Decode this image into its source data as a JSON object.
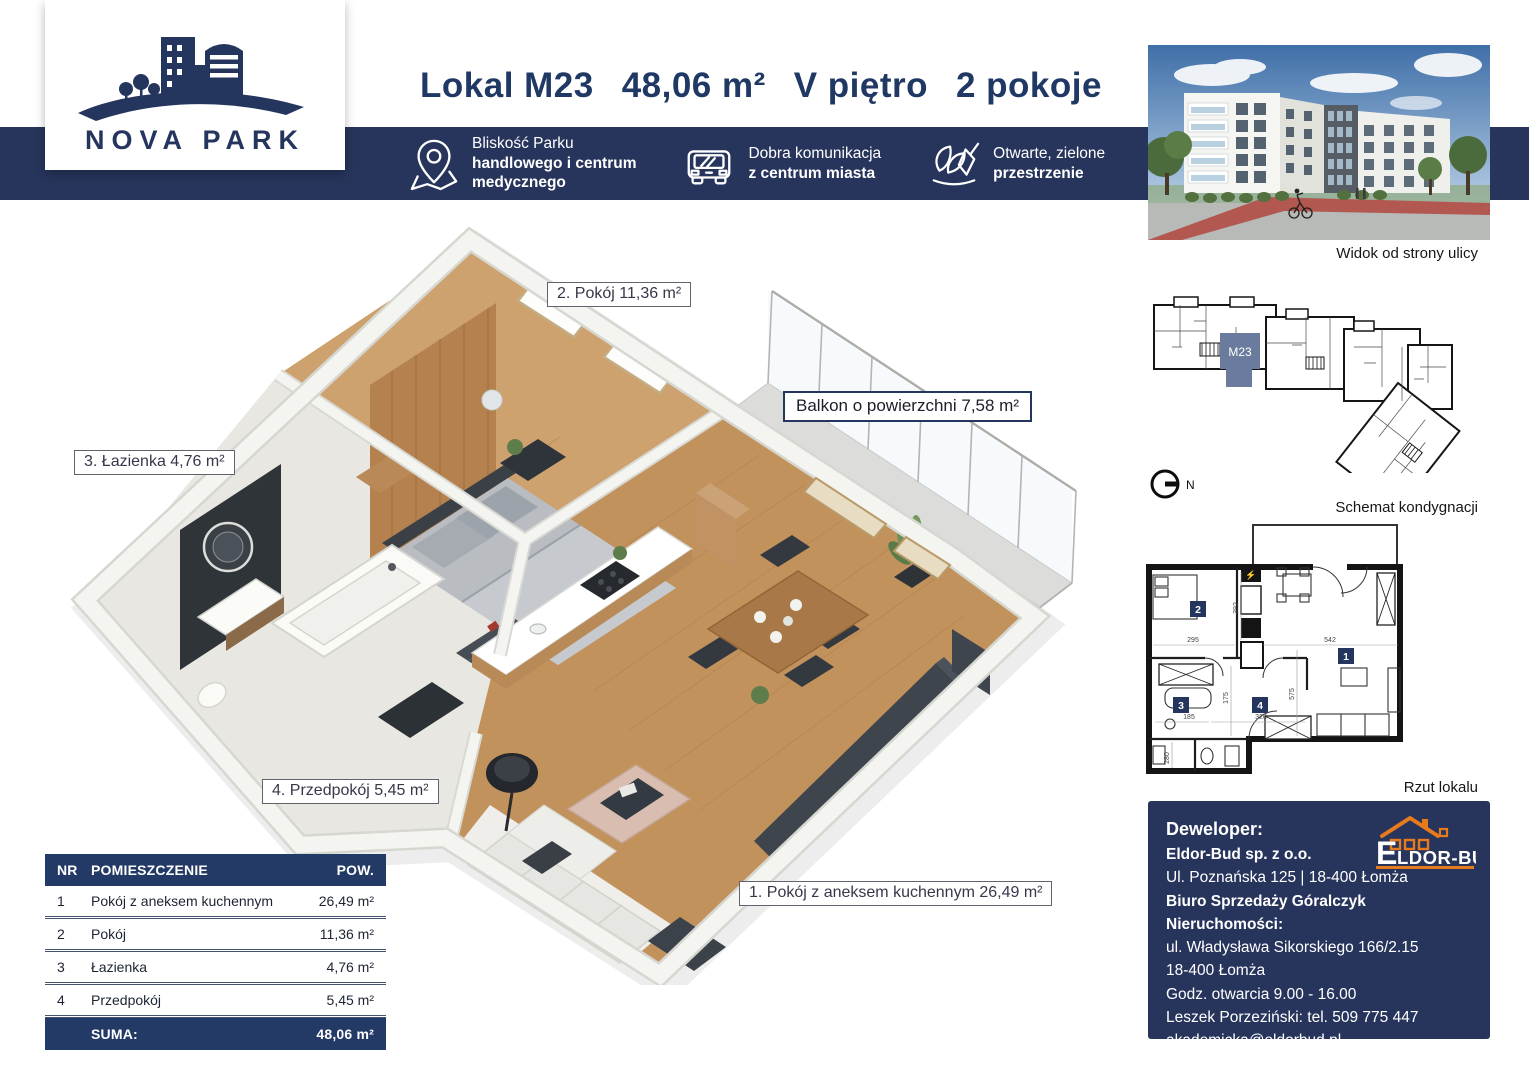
{
  "colors": {
    "navy": "#27355C",
    "navy_text": "#1F3864",
    "orange": "#E87A1E",
    "unit_highlight": "#6B7B9E"
  },
  "brand": {
    "name": "NOVA PARK"
  },
  "header": {
    "unit": "Lokal M23",
    "area": "48,06 m²",
    "floor": "V piętro",
    "rooms": "2 pokoje"
  },
  "features": [
    {
      "icon": "map-pin-icon",
      "lines": [
        "Bliskość Parku",
        "handlowego i centrum",
        "medycznego"
      ]
    },
    {
      "icon": "car-icon",
      "lines": [
        "Dobra komunikacja",
        "z centrum miasta"
      ]
    },
    {
      "icon": "plant-icon",
      "lines": [
        "Otwarte, zielone",
        "przestrzenie"
      ]
    }
  ],
  "plan_labels": {
    "room1": "1. Pokój z aneksem kuchennym 26,49 m²",
    "room2": "2. Pokój 11,36 m²",
    "room3": "3. Łazienka 4,76 m²",
    "room4": "4. Przedpokój 5,45 m²",
    "balcony": "Balkon o powierzchni 7,58 m²"
  },
  "sidebar": {
    "photo_caption": "Widok od strony ulicy",
    "floor_caption": "Schemat kondygnacji",
    "unit_tag": "M23",
    "compass": "N",
    "plan_caption": "Rzut lokalu",
    "plan_rooms": [
      "1",
      "2",
      "3",
      "4"
    ],
    "plan_dims": [
      "295",
      "392",
      "542",
      "575",
      "175",
      "185",
      "280",
      "320"
    ]
  },
  "table": {
    "headers": [
      "NR",
      "POMIESZCZENIE",
      "POW."
    ],
    "rows": [
      {
        "nr": "1",
        "name": "Pokój z aneksem kuchennym",
        "area": "26,49 m²"
      },
      {
        "nr": "2",
        "name": "Pokój",
        "area": "11,36 m²"
      },
      {
        "nr": "3",
        "name": "Łazienka",
        "area": "4,76 m²"
      },
      {
        "nr": "4",
        "name": "Przedpokój",
        "area": "5,45 m²"
      }
    ],
    "sum_label": "SUMA:",
    "sum_value": "48,06 m²"
  },
  "developer": {
    "heading": "Deweloper:",
    "company": "Eldor-Bud sp. z o.o.",
    "address": "Ul. Poznańska 125 | 18-400 Łomża",
    "office": "Biuro Sprzedaży Góralczyk Nieruchomości:",
    "office_addr1": "ul. Władysława Sikorskiego 166/2.15",
    "office_addr2": "18-400 Łomża",
    "hours": "Godz. otwarcia 9.00 - 16.00",
    "phone": "Leszek Porzeziński: tel. 509 775 447",
    "email": "akademicka@eldorbud.pl",
    "website": "www.novapark2.pl",
    "logo_e": "E",
    "logo_rest": "LDOR-BUD"
  }
}
